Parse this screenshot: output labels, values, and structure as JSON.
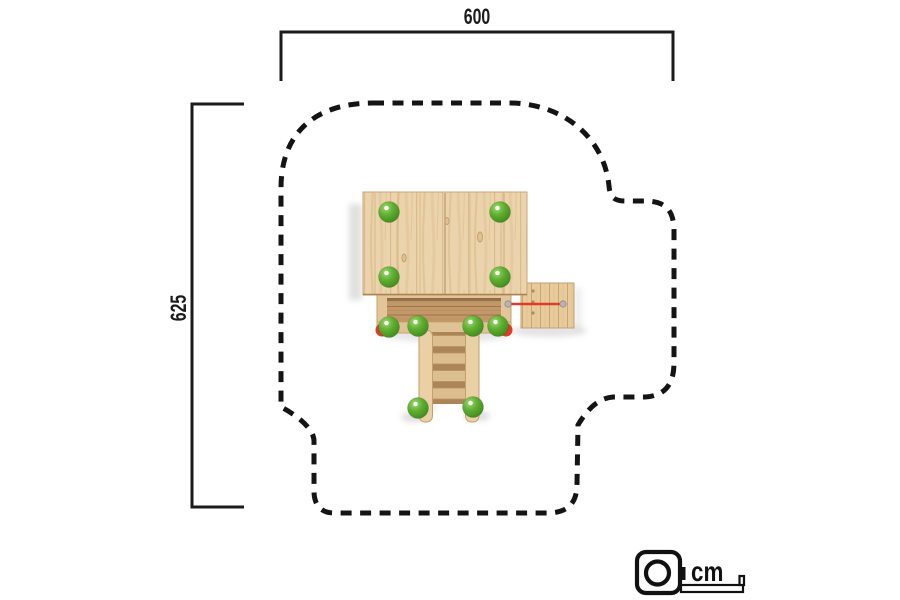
{
  "dimensions": {
    "width_label": "600",
    "height_label": "625",
    "unit_label": "cm"
  },
  "colors": {
    "line_black": "#141414",
    "dimension_black": "#1b1b1b",
    "wood_light": "#ebd4ab",
    "wood_rail": "#dfc396",
    "deck_floor_brown": "#c29868",
    "post_cap_green": "#55a32c",
    "accent_red": "#e23a28",
    "metal_grey": "#b5b5b5",
    "background": "#ffffff"
  },
  "icons": {
    "legend_icon": "measuring-tape-icon"
  }
}
